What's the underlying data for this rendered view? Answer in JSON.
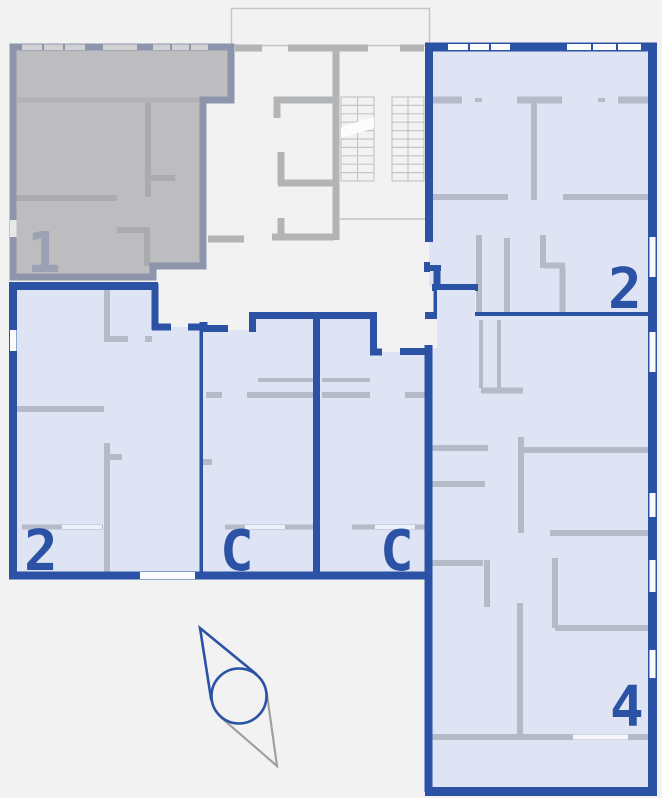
{
  "page": {
    "kind": "building-floor-plan",
    "background_color": "#f2f2f2"
  },
  "palette": {
    "available_outline": "#2b52a4",
    "available_fill": "#dee4f3",
    "unavailable_outline": "#8d95ac",
    "unavailable_fill": "#bdbdbf",
    "unavailable_label_color": "#9aa2b4",
    "interior_wall": "#b4bac8",
    "common_area_wall": "#b3b4b6",
    "window_color": "#fafbfd"
  },
  "units": [
    {
      "id": "unit-1",
      "label": "1",
      "position": "top-left",
      "status": "unavailable"
    },
    {
      "id": "unit-2a",
      "label": "2",
      "position": "top-right",
      "status": "available"
    },
    {
      "id": "unit-2b",
      "label": "2",
      "position": "bottom-left",
      "status": "available"
    },
    {
      "id": "unit-c1",
      "label": "C",
      "position": "bottom-middle-left",
      "status": "available"
    },
    {
      "id": "unit-c2",
      "label": "C",
      "position": "bottom-middle-right",
      "status": "available"
    },
    {
      "id": "unit-4",
      "label": "4",
      "position": "bottom-right",
      "status": "available"
    }
  ],
  "common_area": {
    "stairs": "double-flight-staircase",
    "elevator_shaft_outline": true
  },
  "compass": {
    "type": "north-arrow",
    "north_direction": "upper-left"
  }
}
